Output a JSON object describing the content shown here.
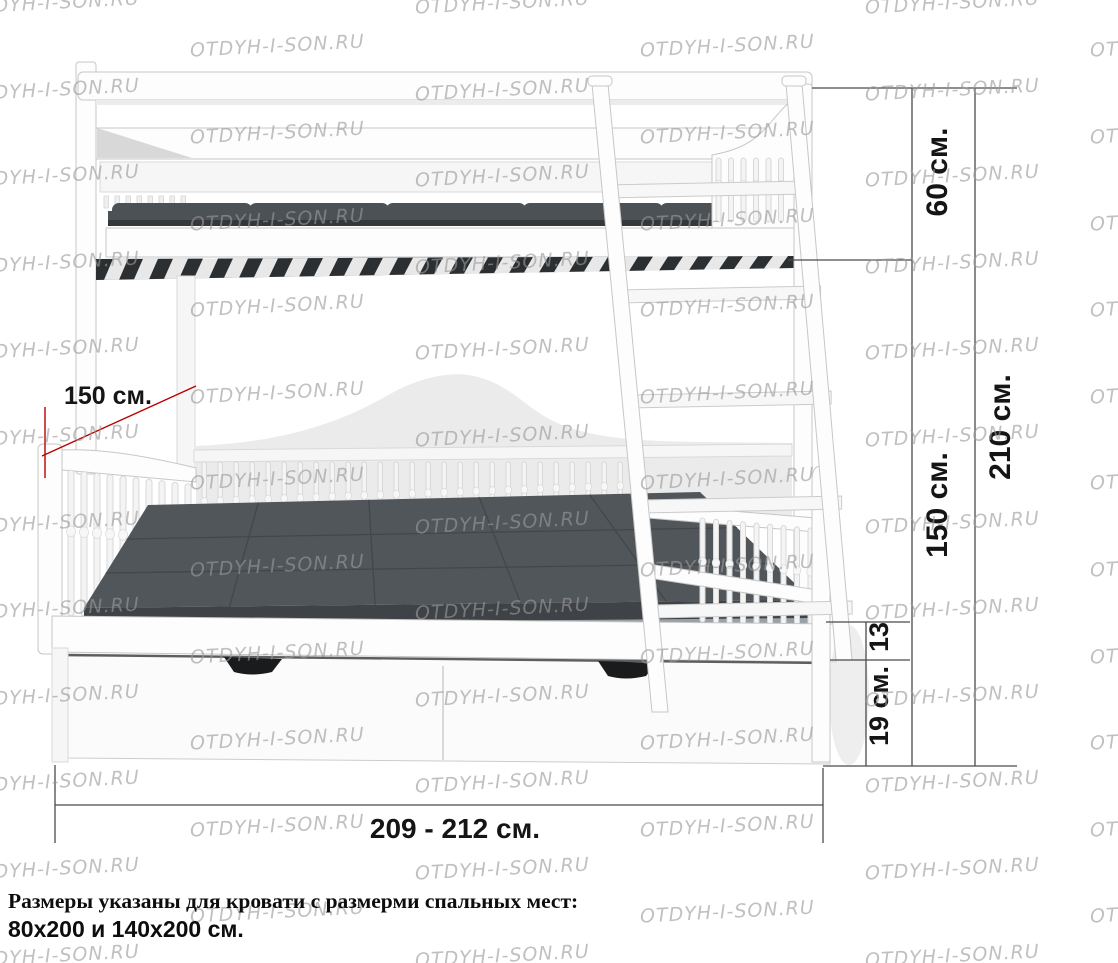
{
  "watermark": {
    "text": "OTDYH-I-SON.RU",
    "color": "#9a9a9a"
  },
  "labels": {
    "upper_section_height": "60 см.",
    "lower_section_height": "150 см.",
    "total_height": "210 см.",
    "platform_thickness": "13",
    "drawer_height": "19 см.",
    "bed_length": "209 - 212 см.",
    "bed_depth": "150 см."
  },
  "caption": {
    "line1": "Размеры указаны для кровати с размерми спальных мест:",
    "line2": "80х200 и 140х200 см."
  },
  "colors": {
    "dimension_line": "#4a4a4a",
    "depth_accent": "#b80000",
    "mattress": "#51565a",
    "frame_white": "#fdfdfd"
  }
}
